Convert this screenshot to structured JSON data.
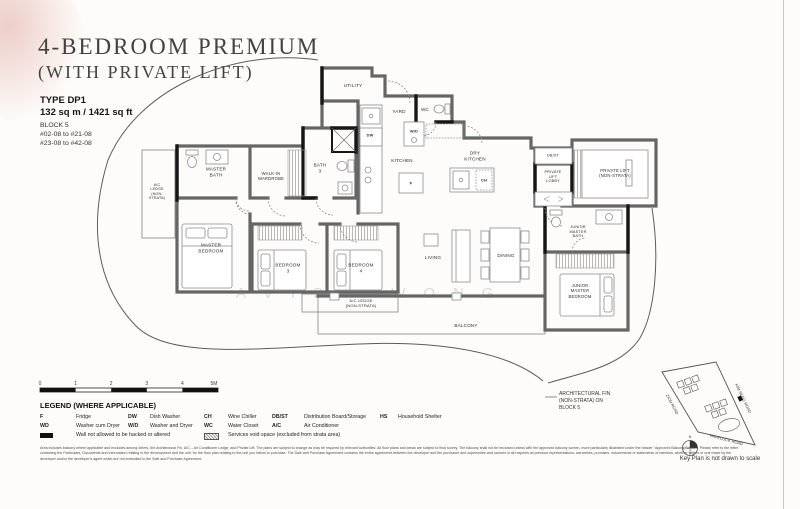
{
  "header": {
    "title_line1": "4-BEDROOM PREMIUM",
    "title_line2": "(WITH PRIVATE LIFT)",
    "type_label": "TYPE DP1",
    "area_label": "132 sq m / 1421 sq ft",
    "block_label": "BLOCK 5",
    "units_line1": "#02-08 to #21-08",
    "units_line2": "#23-08 to #42-08"
  },
  "watermark": "AVIS WONG",
  "rooms": {
    "utility": "UTILITY",
    "yard": "YARD",
    "wc": "WC",
    "wd_appliance": "W/D",
    "dw_appliance": "DW",
    "kitchen": "KITCHEN",
    "fridge": "F",
    "dry_kitchen": "DRY\nKITCHEN",
    "wine_chiller": "CH",
    "db_st": "DB/ST",
    "private_lift_lobby": "PRIVATE\nLIFT\nLOBBY",
    "private_lift": "PRIVATE LIFT\n(NON-STRATA)",
    "master_bath": "MASTER\nBATH",
    "walk_in_wardrobe": "WALK-IN\nWARDROBE",
    "bath_3": "BATH\n3",
    "ac_ledge_left": "A/C\nLEDGE\n(NON-\nSTRATA)",
    "master_bedroom": "MASTER\nBEDROOM",
    "bedroom_3": "BEDROOM\n3",
    "bedroom_4": "BEDROOM\n4",
    "ac_ledge_bottom": "A/C LEDGE\n(NON-STRATA)",
    "living": "LIVING",
    "dining": "DINING",
    "junior_master_bath": "JUNIOR\nMASTER\nBATH",
    "junior_master_bedroom": "JUNIOR\nMASTER\nBEDROOM",
    "balcony": "BALCONY"
  },
  "annotations": {
    "architectural_fin": "ARCHITECTURAL FIN\n(NON-STRATA) ON\nBLOCK 5"
  },
  "scale_bar": {
    "t0": "0",
    "t1": "1",
    "t2": "2",
    "t3": "3",
    "t4": "4",
    "t5": "5M"
  },
  "legend": {
    "title": "LEGEND (WHERE APPLICABLE)",
    "entries": [
      {
        "abbr": "F",
        "label": "Fridge"
      },
      {
        "abbr": "DW",
        "label": "Dish Washer"
      },
      {
        "abbr": "CH",
        "label": "Wine Chiller"
      },
      {
        "abbr": "DB/ST",
        "label": "Distribution Board/Storage"
      },
      {
        "abbr": "HS",
        "label": "Household Shelter"
      },
      {
        "abbr": "WD",
        "label": "Washer cum Dryer"
      },
      {
        "abbr": "W/D",
        "label": "Washer and Dryer"
      },
      {
        "abbr": "WC",
        "label": "Water Closet"
      },
      {
        "abbr": "A/C",
        "label": "Air Conditioner"
      }
    ],
    "wall_note": "Wall not allowed to be hacked or altered",
    "void_note": "Services void space (excluded from strata area)"
  },
  "key_plan": {
    "road_left": "ZION ROAD",
    "road_bottom": "HAVELOCK ROAD",
    "road_right": "KIM SENG ROAD",
    "north": "N",
    "caption": "Key Plan is not drawn to scale"
  },
  "disclaimer": "Area includes balcony where applicable and excludes among others, the Architectural Fin, A/C – Air Conditioner Ledge, and Private Lift. The plans are subject to change as may be required by relevant authorities. All floor plans and areas are subject to final survey. The balcony shall not be enclosed unless with the approved balcony screen, more particularly illustrated under the header \"Approved Balcony Screen\". Please refer to the letter containing the Particulars, Documents and Information relating to the development and the unit, for the floor plan relating to the unit you intend to purchase. The Sale and Purchase Agreement contains the entire agreement between the developer and the purchaser and supersedes and cancels in all respects all previous representations, warranties, promises, inducements or statements of intention, whether written or oral made by the developer and/or the developer's agent which are not embodied in the Sale and Purchase Agreement."
}
